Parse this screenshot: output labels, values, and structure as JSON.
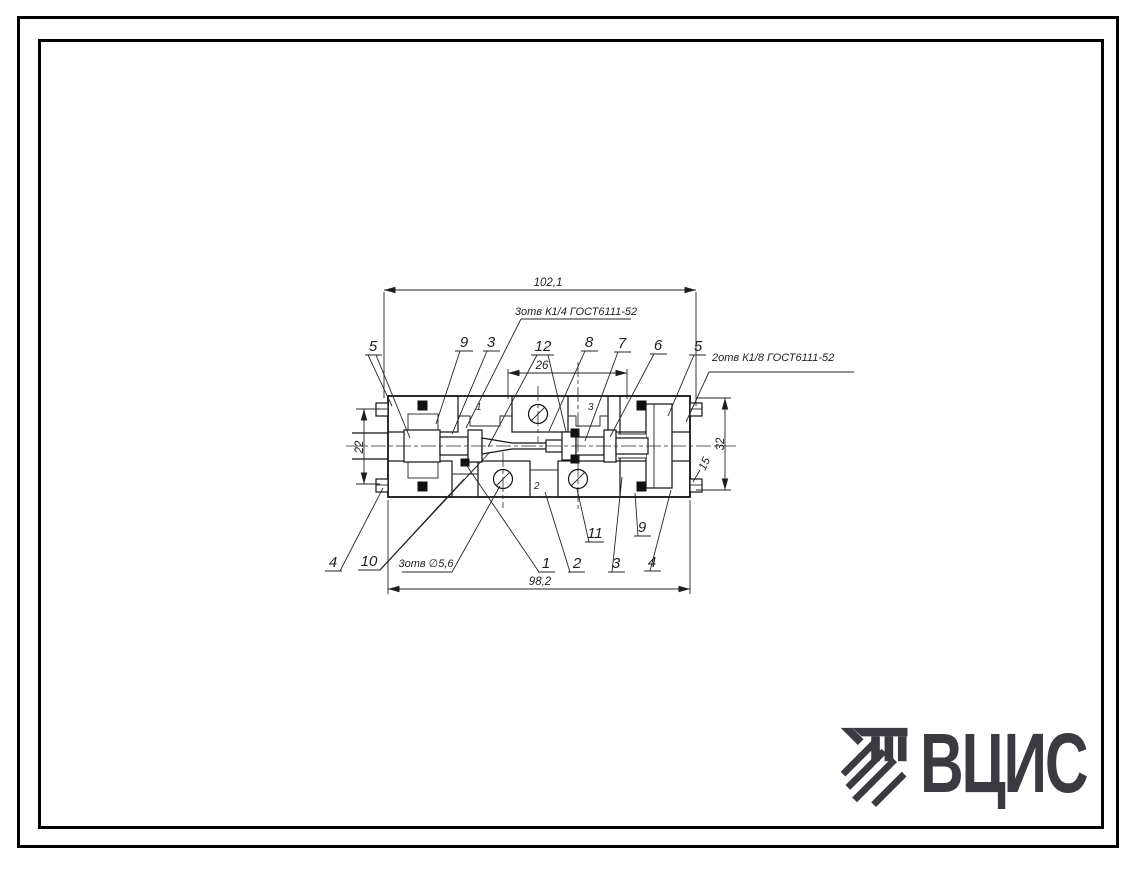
{
  "sheet": {
    "background": "#ffffff",
    "frame_color": "#000000",
    "line_color": "#1e1e1e"
  },
  "logo": {
    "text": "ВЦИС",
    "color": "#3a3a40"
  },
  "drawing": {
    "annotations": {
      "ports_top": "3отв К1/4 ГОСТ6111-52",
      "ports_right": "2отв К1/8 ГОСТ6111-52",
      "holes_bottom": "3отв ∅5,6"
    },
    "dims": {
      "overall_top": "102,1",
      "span_center": "26",
      "overall_bottom": "98,2",
      "height_left": "22",
      "height_right": "32",
      "offset_right": "15"
    },
    "callouts": {
      "t1": "5",
      "t2": "9",
      "t3": "3",
      "t4": "12",
      "t5": "8",
      "t6": "7",
      "t7": "6",
      "t8": "5",
      "b1": "4",
      "b2": "10",
      "b3": "1",
      "b4": "2",
      "b5": "3",
      "b6": "4",
      "s1": "11",
      "s2": "9"
    },
    "port_marks": {
      "p1": "1",
      "p2": "2",
      "p3": "3"
    }
  }
}
